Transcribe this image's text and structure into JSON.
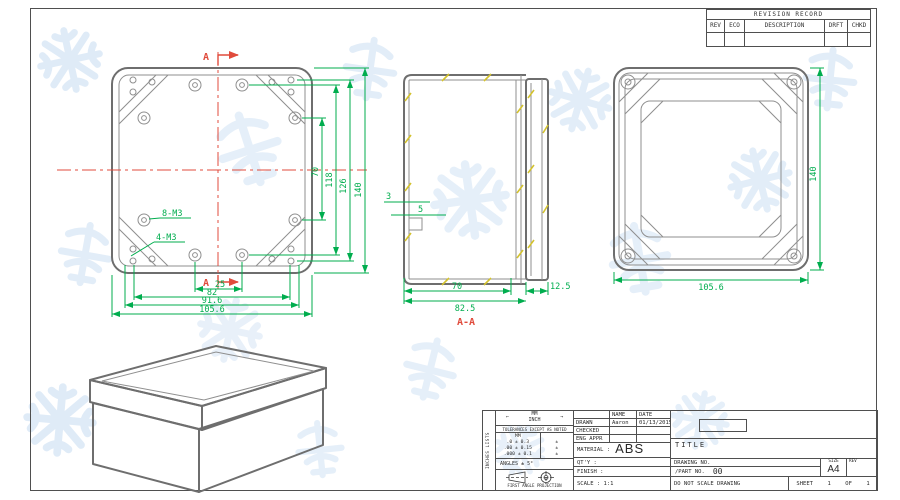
{
  "revision": {
    "title": "REVISION RECORD",
    "col_rev": "REV",
    "col_eco": "ECO",
    "col_desc": "DESCRIPTION",
    "col_drft": "DRFT",
    "col_chkd": "CHKD"
  },
  "front": {
    "marker_top": "A",
    "marker_bottom": "A",
    "label_8m3": "8-M3",
    "label_4m3": "4-M3",
    "d70": "70",
    "d118": "118",
    "d126": "126",
    "d140": "140",
    "d25": "25",
    "d82": "82",
    "d916": "91.6",
    "d1056": "105.6"
  },
  "section": {
    "label": "A-A",
    "d3": "3",
    "d5": "5",
    "d70": "70",
    "d825": "82.5",
    "d125": "12.5"
  },
  "lid": {
    "d140": "140",
    "d1056": "105.6"
  },
  "tb": {
    "side_note": "INCHES LISTS",
    "units_mm": "MM",
    "units_inch": "INCH",
    "arrow_left": "←",
    "arrow_right": "→",
    "tol_heading": "TOLERANCES EXCEPT AS NOTED",
    "tol_col_mm": "MM",
    "tol_r1": ".0 ± 0.3",
    "tol_r2": ".00 ± 0.15",
    "tol_r3": ".000 ± 0.1",
    "tol_i1": "±",
    "tol_i2": "±",
    "tol_i3": "±",
    "angles": "ANGLES ± 5°",
    "projection": "FIRST ANGLE PROJECTION",
    "name_h": "NAME",
    "date_h": "DATE",
    "drawn": "DRAWN",
    "drawn_name": "Aaron",
    "drawn_date": "01/13/2015",
    "checked": "CHECKED",
    "eng_appr": "ENG APPR",
    "material_label": "MATERIAL :",
    "material_value": "ABS",
    "qty": "QT'Y :",
    "finish": "FINISH :",
    "scale": "SCALE : 1:1",
    "title": "TITLE",
    "drawing_no": "DRAWING NO.",
    "part_no": "/PART  NO.",
    "part_no_value": "00",
    "size_h": "SIZE",
    "size_v": "A4",
    "rev_h": "REV",
    "do_not_scale": "DO NOT SCALE DRAWING",
    "sheet": "SHEET",
    "sheet_no": "1",
    "of": "OF",
    "of_no": "1"
  },
  "colors": {
    "dim_green": "#00ad4e",
    "marker_red": "#e04b3c",
    "outline_gray": "#6e6e6e",
    "hatch_yellow": "#d3c22e",
    "watermark_blue": "#c6dcf2"
  }
}
